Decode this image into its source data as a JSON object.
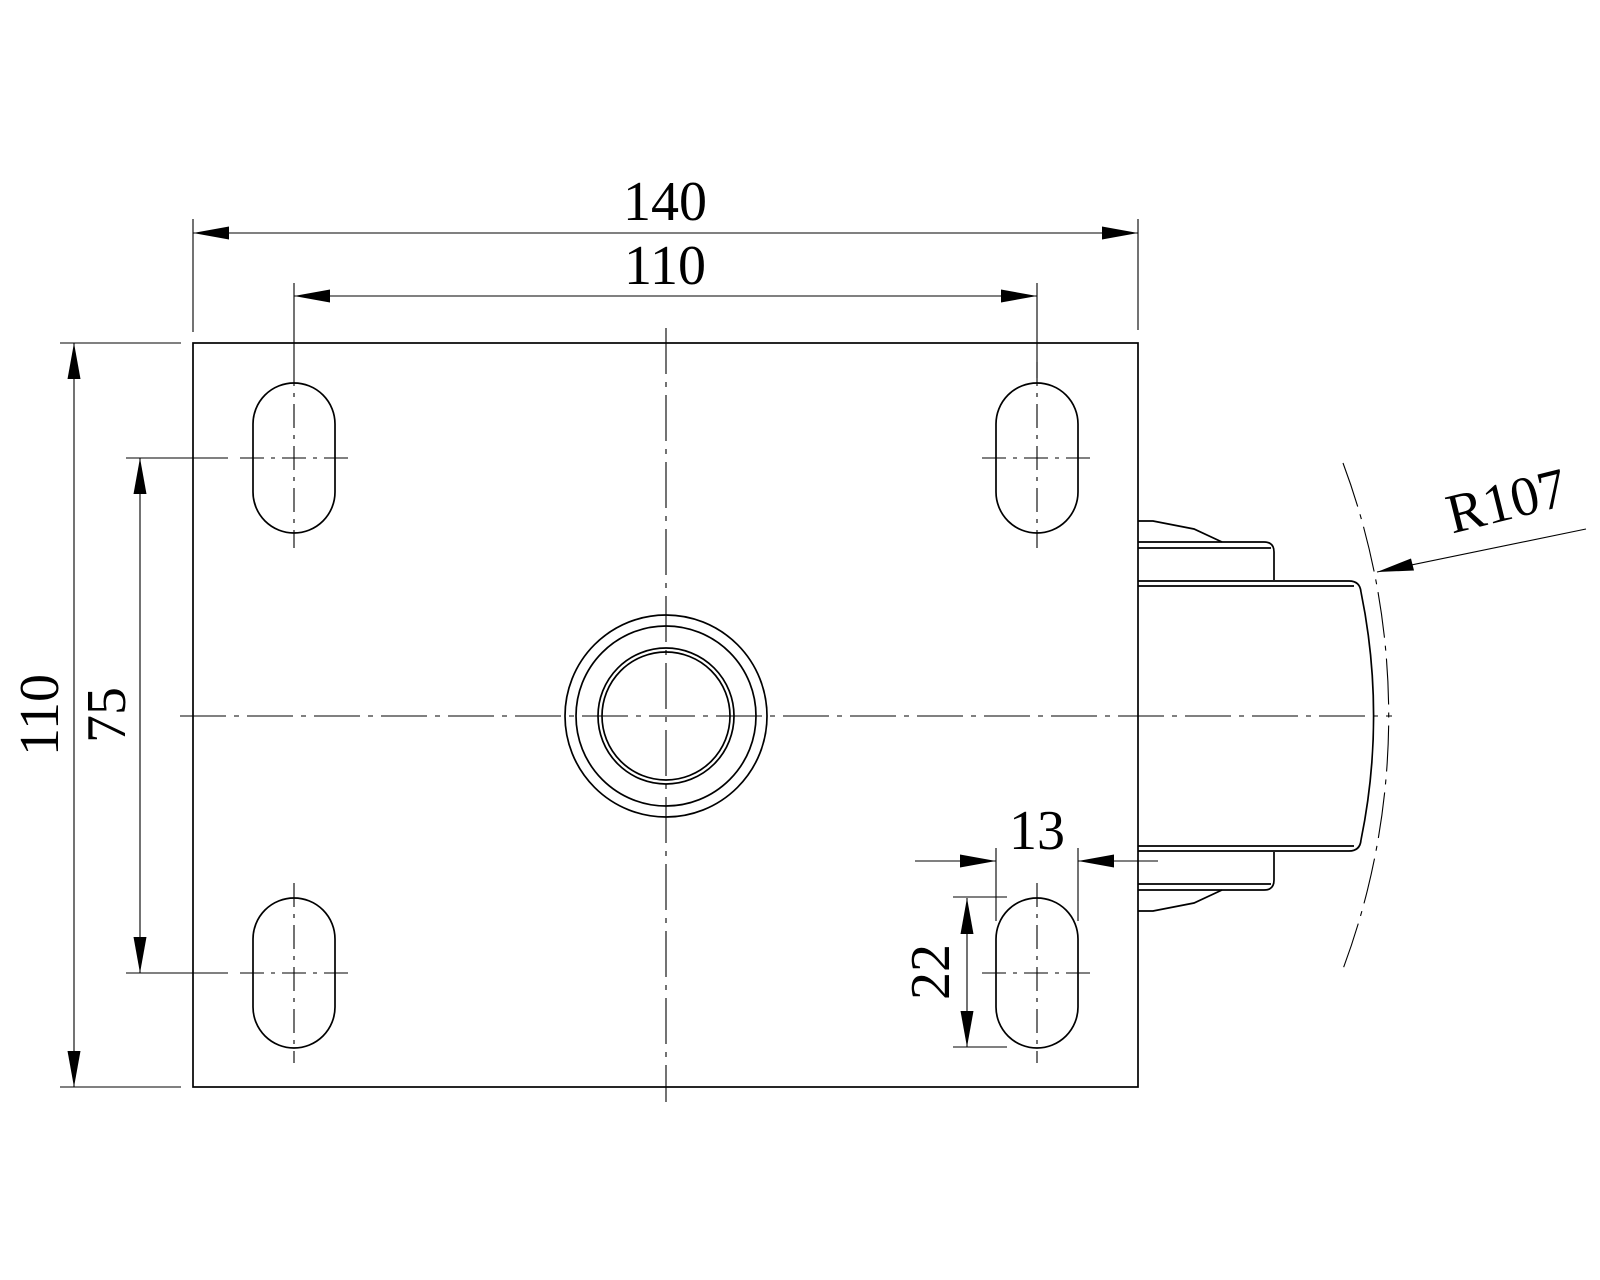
{
  "drawing": {
    "description": "Engineering drawing, top view of caster swivel top plate with four slotted mounting holes, central kingpin hole and wheel protruding at right",
    "colors": {
      "line": "#000000",
      "background": "#ffffff"
    },
    "dims": {
      "plate_width": "140",
      "hole_spacing_x": "110",
      "plate_depth": "110",
      "hole_spacing_y": "75",
      "slot_width": "13",
      "slot_length": "22",
      "swivel_radius": "R107"
    }
  }
}
